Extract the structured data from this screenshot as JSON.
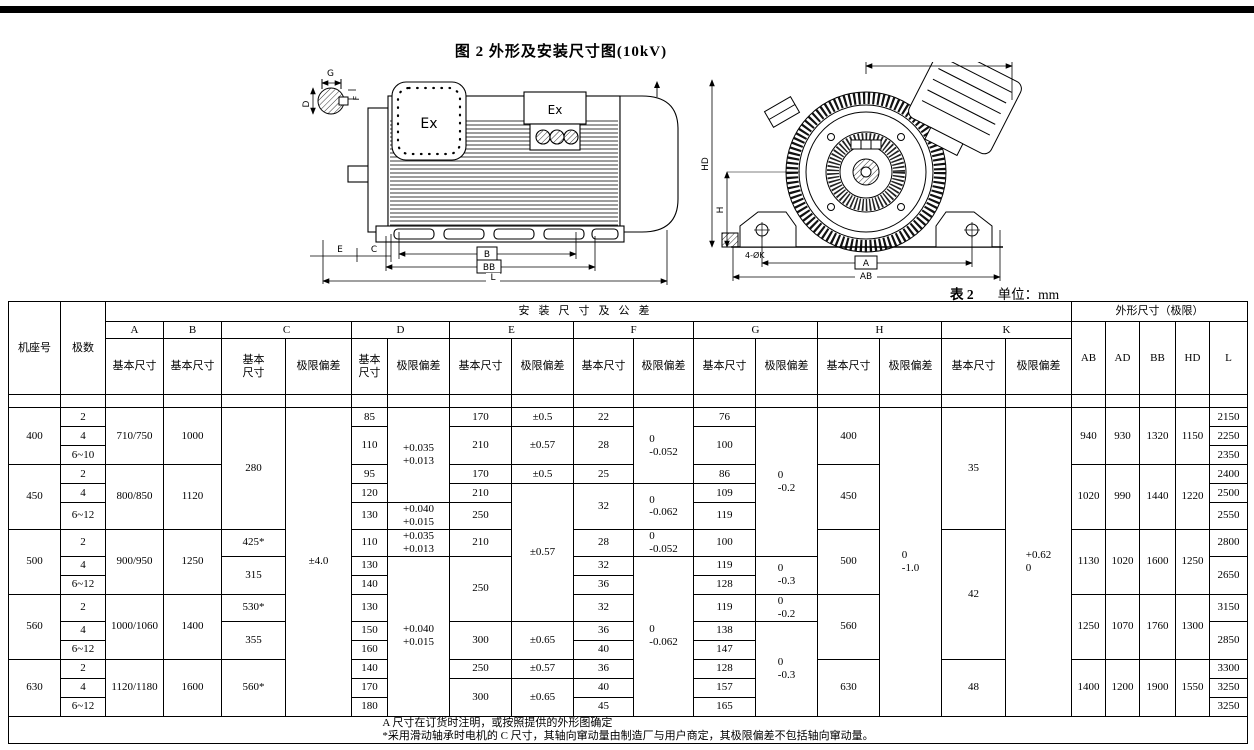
{
  "page": {
    "figure_title": "图 2 外形及安装尺寸图(10kV)",
    "table_caption": "表 2",
    "unit_label": "单位：mm"
  },
  "drawing": {
    "labels": {
      "g": "G",
      "d": "D",
      "f": "F",
      "ex1": "Ex",
      "ex2": "Ex",
      "e": "E",
      "c": "C",
      "b": "B",
      "bb": "BB",
      "l": "L",
      "ad": "AD",
      "hd": "HD",
      "h": "H",
      "k4": "4-ØK",
      "a": "A",
      "ab": "AB"
    }
  },
  "table": {
    "grid": [
      {
        "h": 20,
        "cells": [
          {
            "t": "机座号",
            "rs": 3,
            "c": "hd"
          },
          {
            "t": "极数",
            "rs": 3,
            "c": "hd"
          },
          {
            "t": "安装尺寸及公差",
            "cs": 16,
            "c": "hd grp"
          },
          {
            "t": "外形尺寸（极限）",
            "cs": 5,
            "c": "hd"
          }
        ]
      },
      {
        "h": 17,
        "cells": [
          {
            "t": "A",
            "c": "hd"
          },
          {
            "t": "B",
            "c": "hd"
          },
          {
            "t": "C",
            "cs": 2,
            "c": "hd"
          },
          {
            "t": "D",
            "cs": 2,
            "c": "hd"
          },
          {
            "t": "E",
            "cs": 2,
            "c": "hd"
          },
          {
            "t": "F",
            "cs": 2,
            "c": "hd"
          },
          {
            "t": "G",
            "cs": 2,
            "c": "hd"
          },
          {
            "t": "H",
            "cs": 2,
            "c": "hd"
          },
          {
            "t": "K",
            "cs": 2,
            "c": "hd"
          },
          {
            "t": "AB",
            "rs": 2,
            "c": "hd"
          },
          {
            "t": "AD",
            "rs": 2,
            "c": "hd"
          },
          {
            "t": "BB",
            "rs": 2,
            "c": "hd"
          },
          {
            "t": "HD",
            "rs": 2,
            "c": "hd"
          },
          {
            "t": "L",
            "rs": 2,
            "c": "hd"
          }
        ]
      },
      {
        "h": 56,
        "cells": [
          {
            "t": "基本尺寸",
            "c": "sm"
          },
          {
            "t": "基本尺寸",
            "c": "sm"
          },
          {
            "t": "基本\n尺寸",
            "c": "sm"
          },
          {
            "t": "极限偏差",
            "c": "sm"
          },
          {
            "t": "基本\n尺寸",
            "c": "sm"
          },
          {
            "t": "极限偏差",
            "c": "sm"
          },
          {
            "t": "基本尺寸",
            "c": "sm"
          },
          {
            "t": "极限偏差",
            "c": "sm"
          },
          {
            "t": "基本尺寸",
            "c": "sm"
          },
          {
            "t": "极限偏差",
            "c": "sm"
          },
          {
            "t": "基本尺寸",
            "c": "sm"
          },
          {
            "t": "极限偏差",
            "c": "sm"
          },
          {
            "t": "基本尺寸",
            "c": "sm"
          },
          {
            "t": "极限偏差",
            "c": "sm"
          },
          {
            "t": "基本尺寸",
            "c": "sm"
          },
          {
            "t": "极限偏差",
            "c": "sm"
          }
        ]
      },
      {
        "h": 10,
        "cells": [
          {
            "t": ""
          },
          {
            "t": ""
          },
          {
            "t": ""
          },
          {
            "t": ""
          },
          {
            "t": ""
          },
          {
            "t": ""
          },
          {
            "t": ""
          },
          {
            "t": ""
          },
          {
            "t": ""
          },
          {
            "t": ""
          },
          {
            "t": ""
          },
          {
            "t": ""
          },
          {
            "t": ""
          },
          {
            "t": ""
          },
          {
            "t": ""
          },
          {
            "t": ""
          },
          {
            "t": ""
          },
          {
            "t": ""
          },
          {
            "t": ""
          },
          {
            "t": ""
          },
          {
            "t": ""
          },
          {
            "t": ""
          },
          {
            "t": ""
          }
        ]
      },
      {
        "h": 19,
        "cells": [
          {
            "t": "400",
            "rs": 3
          },
          {
            "t": "2"
          },
          {
            "t": "710/750",
            "rs": 3
          },
          {
            "t": "1000",
            "rs": 3
          },
          {
            "t": "280",
            "rs": 6
          },
          {
            "t": "±4.0",
            "rs": 15,
            "c": "big"
          },
          {
            "t": "85"
          },
          {
            "t": "+0.035\n+0.013",
            "rs": 5,
            "c": "tol"
          },
          {
            "t": "170"
          },
          {
            "t": "±0.5"
          },
          {
            "t": "22"
          },
          {
            "t": "0\n-0.052",
            "rs": 4,
            "c": "tol"
          },
          {
            "t": "76"
          },
          {
            "t": "0\n-0.2",
            "rs": 7,
            "c": "tol"
          },
          {
            "t": "400",
            "rs": 3
          },
          {
            "t": "0\n-1.0",
            "rs": 15,
            "c": "tol"
          },
          {
            "t": "35",
            "rs": 6
          },
          {
            "t": "+0.62\n0",
            "rs": 15,
            "c": "tol"
          },
          {
            "t": "940",
            "rs": 3
          },
          {
            "t": "930",
            "rs": 3
          },
          {
            "t": "1320",
            "rs": 3
          },
          {
            "t": "1150",
            "rs": 3
          },
          {
            "t": "2150"
          }
        ]
      },
      {
        "h": 19,
        "cells": [
          {
            "t": "4"
          },
          {
            "t": "110",
            "rs": 2
          },
          {
            "t": "210",
            "rs": 2
          },
          {
            "t": "±0.57",
            "rs": 2
          },
          {
            "t": "28",
            "rs": 2
          },
          {
            "t": "100",
            "rs": 2
          },
          {
            "t": "2250"
          }
        ]
      },
      {
        "h": 19,
        "cells": [
          {
            "t": "6~10"
          },
          {
            "t": "2350"
          }
        ]
      },
      {
        "h": 19,
        "cells": [
          {
            "t": "450",
            "rs": 3
          },
          {
            "t": "2"
          },
          {
            "t": "800/850",
            "rs": 3
          },
          {
            "t": "1120",
            "rs": 3
          },
          {
            "t": "95"
          },
          {
            "t": "170"
          },
          {
            "t": "±0.5"
          },
          {
            "t": "25"
          },
          {
            "t": "86"
          },
          {
            "t": "450",
            "rs": 3
          },
          {
            "t": "1020",
            "rs": 3
          },
          {
            "t": "990",
            "rs": 3
          },
          {
            "t": "1440",
            "rs": 3
          },
          {
            "t": "1220",
            "rs": 3
          },
          {
            "t": "2400"
          }
        ]
      },
      {
        "h": 19,
        "cells": [
          {
            "t": "4"
          },
          {
            "t": "120"
          },
          {
            "t": "210"
          },
          {
            "t": "±0.57",
            "rs": 6
          },
          {
            "t": "32",
            "rs": 2
          },
          {
            "t": "0\n-0.062",
            "rs": 2,
            "c": "tol"
          },
          {
            "t": "109"
          },
          {
            "t": "2500"
          }
        ]
      },
      {
        "h": 19,
        "cells": [
          {
            "t": "6~12"
          },
          {
            "t": "130"
          },
          {
            "t": "+0.040\n+0.015",
            "c": "tol"
          },
          {
            "t": "250"
          },
          {
            "t": "119"
          },
          {
            "t": "2550"
          }
        ]
      },
      {
        "h": 19,
        "cells": [
          {
            "t": "500",
            "rs": 3
          },
          {
            "t": "2"
          },
          {
            "t": "900/950",
            "rs": 3
          },
          {
            "t": "1250",
            "rs": 3
          },
          {
            "t": "425*"
          },
          {
            "t": "110"
          },
          {
            "t": "+0.035\n+0.013",
            "c": "tol"
          },
          {
            "t": "210"
          },
          {
            "t": "28"
          },
          {
            "t": "0\n-0.052",
            "c": "tol"
          },
          {
            "t": "100"
          },
          {
            "t": "500",
            "rs": 3
          },
          {
            "t": "42",
            "rs": 6
          },
          {
            "t": "1130",
            "rs": 3
          },
          {
            "t": "1020",
            "rs": 3
          },
          {
            "t": "1600",
            "rs": 3
          },
          {
            "t": "1250",
            "rs": 3
          },
          {
            "t": "2800"
          }
        ]
      },
      {
        "h": 19,
        "cells": [
          {
            "t": "4"
          },
          {
            "t": "315",
            "rs": 2
          },
          {
            "t": "130"
          },
          {
            "t": "+0.040\n+0.015",
            "rs": 8,
            "c": "tol"
          },
          {
            "t": "250",
            "rs": 3
          },
          {
            "t": "32"
          },
          {
            "t": "0\n-0.062",
            "rs": 8,
            "c": "tol"
          },
          {
            "t": "119"
          },
          {
            "t": "0\n-0.3",
            "rs": 2,
            "c": "tol"
          },
          {
            "t": "2650",
            "rs": 2
          }
        ]
      },
      {
        "h": 19,
        "cells": [
          {
            "t": "6~12"
          },
          {
            "t": "140"
          },
          {
            "t": "36"
          },
          {
            "t": "128"
          }
        ]
      },
      {
        "h": 19,
        "cells": [
          {
            "t": "560",
            "rs": 3
          },
          {
            "t": "2"
          },
          {
            "t": "1000/1060",
            "rs": 3
          },
          {
            "t": "1400",
            "rs": 3
          },
          {
            "t": "530*"
          },
          {
            "t": "130"
          },
          {
            "t": "32"
          },
          {
            "t": "119"
          },
          {
            "t": "0\n-0.2",
            "c": "tol"
          },
          {
            "t": "560",
            "rs": 3
          },
          {
            "t": "1250",
            "rs": 3
          },
          {
            "t": "1070",
            "rs": 3
          },
          {
            "t": "1760",
            "rs": 3
          },
          {
            "t": "1300",
            "rs": 3
          },
          {
            "t": "3150"
          }
        ]
      },
      {
        "h": 19,
        "cells": [
          {
            "t": "4"
          },
          {
            "t": "355",
            "rs": 2
          },
          {
            "t": "150"
          },
          {
            "t": "300",
            "rs": 2
          },
          {
            "t": "±0.65",
            "rs": 2
          },
          {
            "t": "36"
          },
          {
            "t": "138"
          },
          {
            "t": "0\n-0.3",
            "rs": 5,
            "c": "tol"
          },
          {
            "t": "2850",
            "rs": 2
          }
        ]
      },
      {
        "h": 19,
        "cells": [
          {
            "t": "6~12"
          },
          {
            "t": "160"
          },
          {
            "t": "40"
          },
          {
            "t": "147"
          }
        ]
      },
      {
        "h": 19,
        "cells": [
          {
            "t": "630",
            "rs": 3
          },
          {
            "t": "2"
          },
          {
            "t": "1120/1180",
            "rs": 3
          },
          {
            "t": "1600",
            "rs": 3
          },
          {
            "t": "560*",
            "rs": 3
          },
          {
            "t": "140"
          },
          {
            "t": "250"
          },
          {
            "t": "±0.57"
          },
          {
            "t": "36"
          },
          {
            "t": "128"
          },
          {
            "t": "630",
            "rs": 3
          },
          {
            "t": "48",
            "rs": 3
          },
          {
            "t": "1400",
            "rs": 3
          },
          {
            "t": "1200",
            "rs": 3
          },
          {
            "t": "1900",
            "rs": 3
          },
          {
            "t": "1550",
            "rs": 3
          },
          {
            "t": "3300"
          }
        ]
      },
      {
        "h": 19,
        "cells": [
          {
            "t": "4"
          },
          {
            "t": "170"
          },
          {
            "t": "300",
            "rs": 2
          },
          {
            "t": "±0.65",
            "rs": 2
          },
          {
            "t": "40"
          },
          {
            "t": "157"
          },
          {
            "t": "3250"
          }
        ]
      },
      {
        "h": 19,
        "cells": [
          {
            "t": "6~12"
          },
          {
            "t": "180"
          },
          {
            "t": "45"
          },
          {
            "t": "165"
          },
          {
            "t": "3250"
          }
        ]
      },
      {
        "cells": [
          {
            "t": "A 尺寸在订货时注明，或按照提供的外形图确定\n*采用滑动轴承时电机的 C 尺寸，其轴向窜动量由制造厂与用户商定，其极限偏差不包括轴向窜动量。",
            "cs": 23,
            "c": "notes"
          }
        ]
      }
    ]
  }
}
